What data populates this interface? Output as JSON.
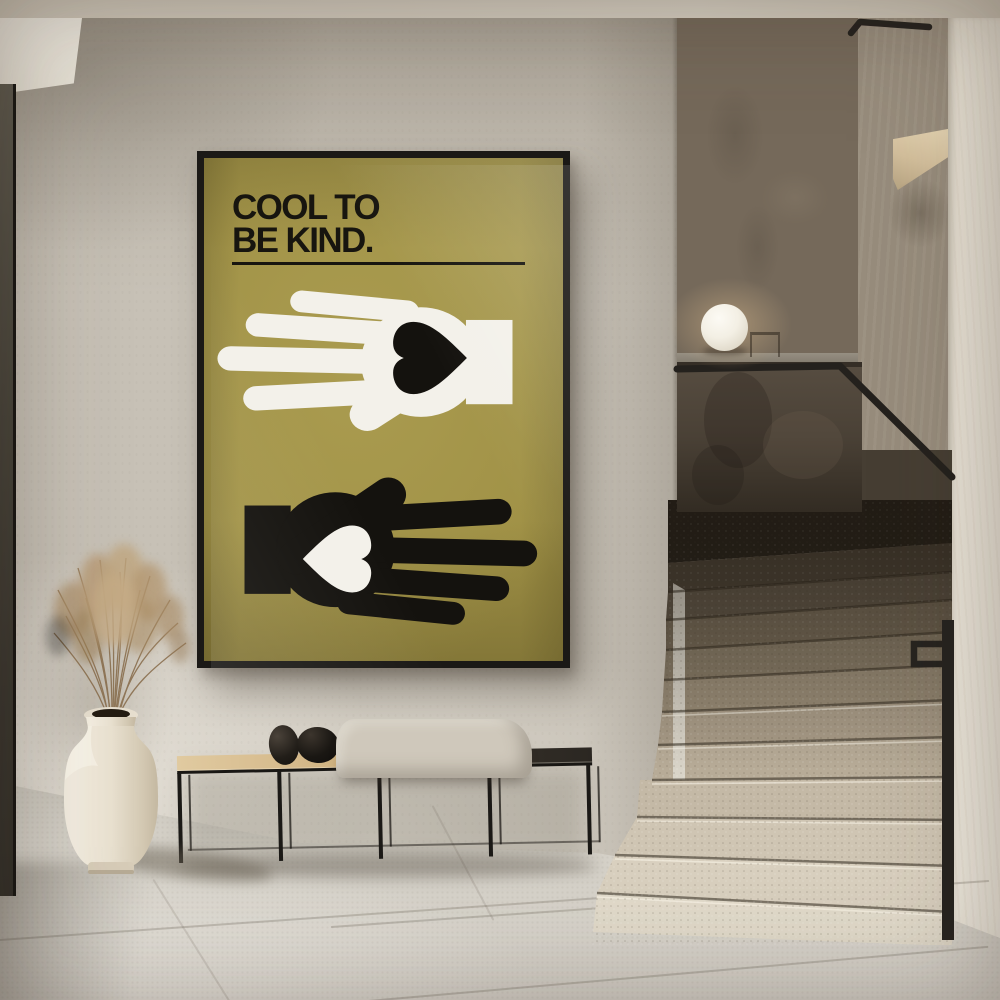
{
  "scene": {
    "description": "Minimalist hallway interior photo: framed motivational poster on plaster wall, black metal bench with blanket and stones, cream vase with dried pampas grass, terrazzo staircase with black handrail and sphere lamp"
  },
  "poster": {
    "title_line1": "COOL TO",
    "title_line2": "BE KIND."
  },
  "theme": {
    "poster-olive": "#9f9045",
    "poster-olive-dark": "#857733",
    "ink": "#17150f",
    "frame": "#1b1916",
    "hand-white": "#f3f1ea",
    "hand-black": "#14120e",
    "wall": "#c7c1b6",
    "ceiling": "#d4cdc0",
    "floor": "#d6d2c9",
    "panel-dark": "#6b6154",
    "panel-warm": "#a8937a",
    "parapet": "#4c433a",
    "slot-wall": "#9c9183",
    "bright-wall": "#ece6da",
    "rail": "#24211d",
    "wood": "#d2b586",
    "bench-dark": "#37322b",
    "blanket": "#cfc8bb",
    "pebble": "#1d1914",
    "vase": "#eae2d2",
    "plume": "#b49872",
    "lamp": "#f6f3ea"
  }
}
